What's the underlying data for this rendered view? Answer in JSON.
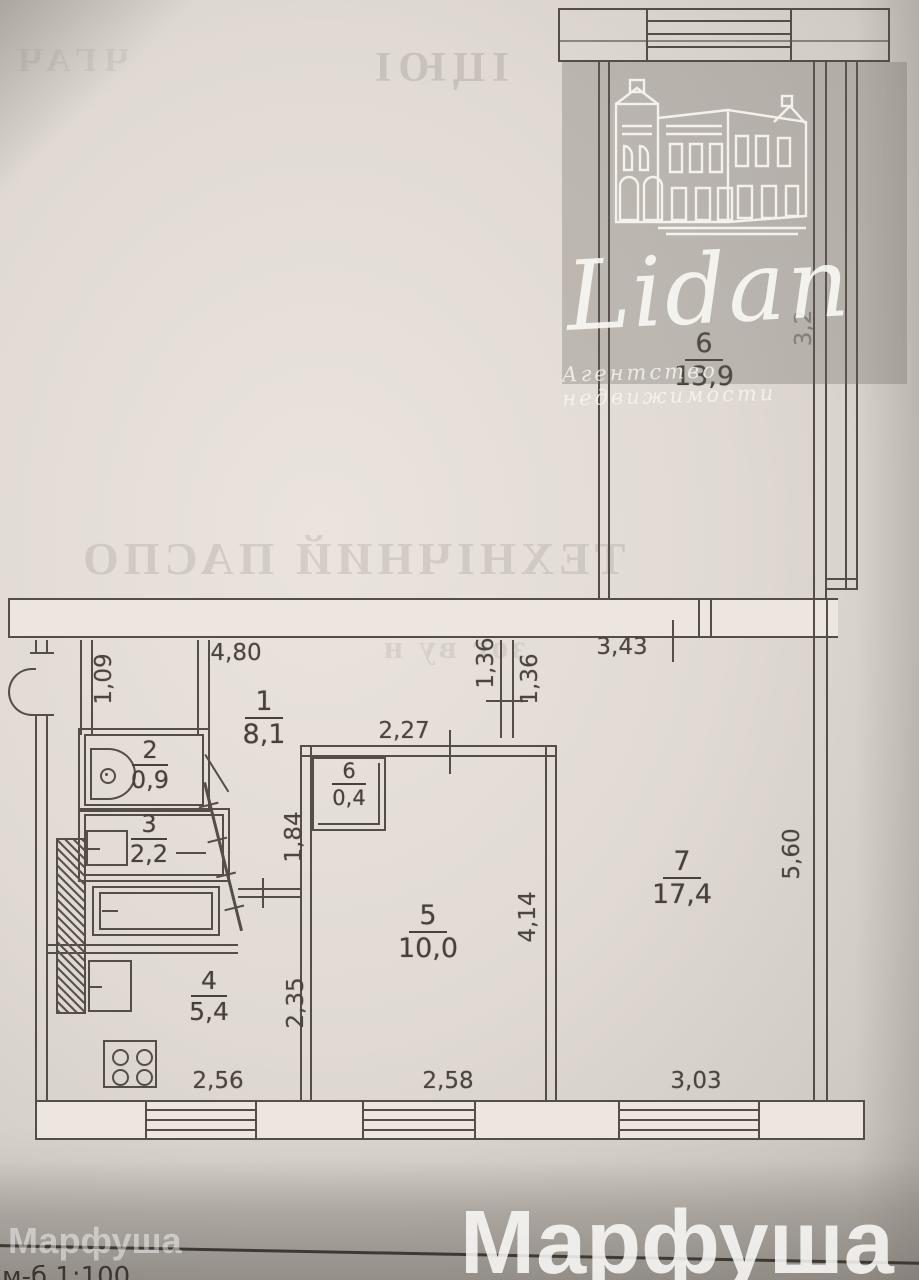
{
  "agency_watermark": {
    "brand": "Lidan",
    "tagline": "Агентство недвижимости"
  },
  "photo_watermark": {
    "small": "Марфуша",
    "large": "Марфуша"
  },
  "scale_note": "м-б 1:100",
  "bleed_through": {
    "top_left_fragment": "ЧГАЧ",
    "top_right_fragment": "ІЦЮІ",
    "mirrored_title": "ТЕХНІЧНИЙ ПАСПО",
    "hall_fragment": "зог        ву      н"
  },
  "rooms": {
    "r6top": {
      "num": "6",
      "area": "13,9"
    },
    "r1": {
      "num": "1",
      "area": "8,1"
    },
    "r2": {
      "num": "2",
      "area": "0,9"
    },
    "r3": {
      "num": "3",
      "area": "2,2"
    },
    "r4": {
      "num": "4",
      "area": "5,4"
    },
    "r5": {
      "num": "5",
      "area": "10,0"
    },
    "r6closet": {
      "num": "6",
      "area": "0,4"
    },
    "r7": {
      "num": "7",
      "area": "17,4"
    }
  },
  "dims": {
    "hall_top": "4,80",
    "hall_left": "1,09",
    "stub_left": "1,36",
    "stub_right": "1,36",
    "hall_right": "3,43",
    "room5_top": "2,27",
    "closet_side": "1,84",
    "kitchen_side": "2,35",
    "room5_side": "4,14",
    "room7_side": "5,60",
    "kitchen_bottom": "2,56",
    "room5_bottom": "2,58",
    "room7_bottom": "3,03",
    "neighbor_side": "3,2"
  }
}
